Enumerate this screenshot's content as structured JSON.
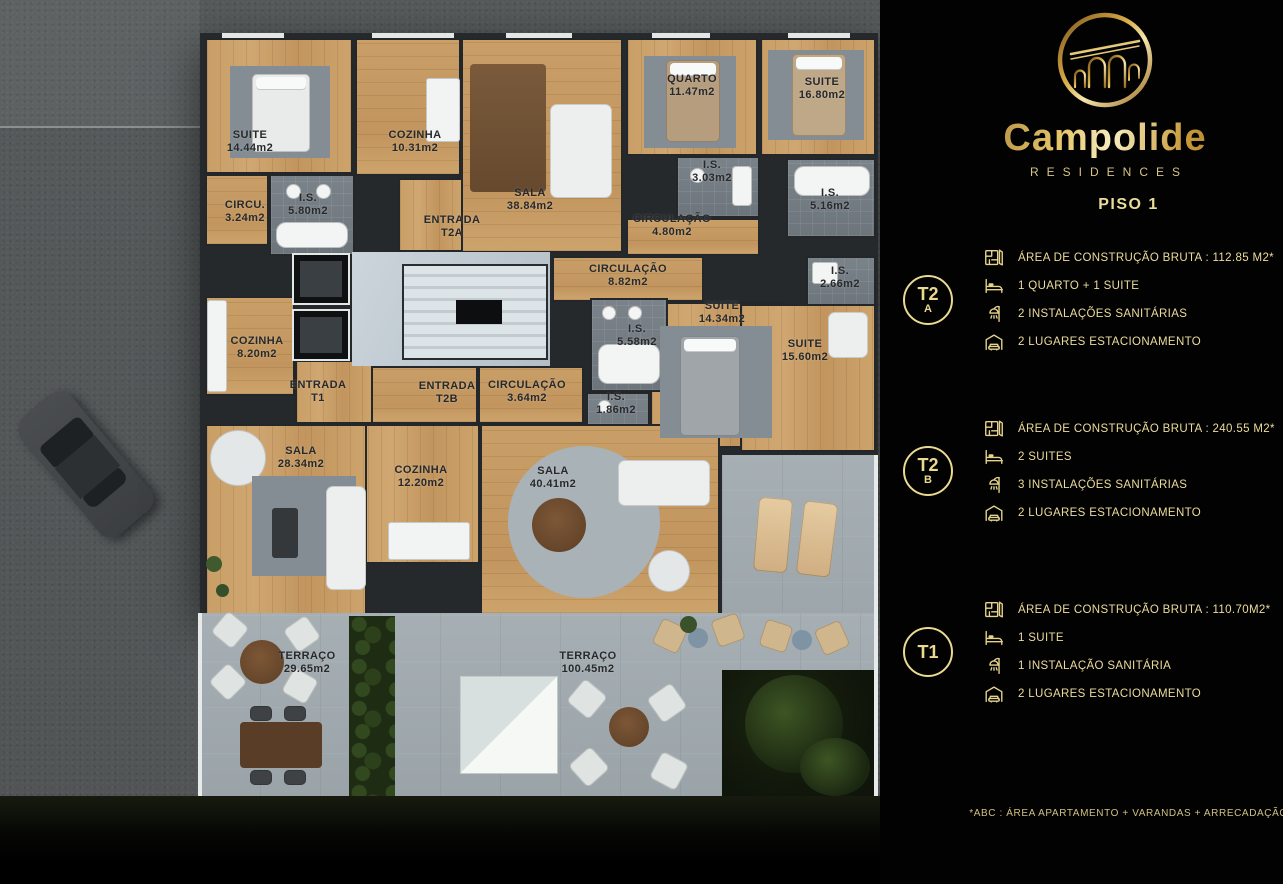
{
  "brand": {
    "name": "Campolide",
    "subtitle": "RESIDENCES"
  },
  "floor": {
    "title": "PISO 1"
  },
  "footnote": "*ABC :  ÁREA APARTAMENTO + VARANDAS + ARRECADAÇÃO",
  "accent_gold": "#ead98f",
  "units": [
    {
      "id": "T2A",
      "badge_top": "T2",
      "badge_bottom": "A",
      "specs": [
        {
          "icon": "floorplan-icon",
          "text": "ÁREA DE CONSTRUÇÃO BRUTA :  112.85 M2*"
        },
        {
          "icon": "bed-icon",
          "text": "1 QUARTO + 1 SUITE"
        },
        {
          "icon": "shower-icon",
          "text": "2 INSTALAÇÕES SANITÁRIAS"
        },
        {
          "icon": "garage-icon",
          "text": "2 LUGARES ESTACIONAMENTO"
        }
      ]
    },
    {
      "id": "T2B",
      "badge_top": "T2",
      "badge_bottom": "B",
      "specs": [
        {
          "icon": "floorplan-icon",
          "text": "ÁREA DE CONSTRUÇÃO BRUTA :  240.55 M2*"
        },
        {
          "icon": "bed-icon",
          "text": "2 SUITES"
        },
        {
          "icon": "shower-icon",
          "text": "3 INSTALAÇÕES SANITÁRIAS"
        },
        {
          "icon": "garage-icon",
          "text": "2 LUGARES ESTACIONAMENTO"
        }
      ]
    },
    {
      "id": "T1",
      "badge_top": "T1",
      "badge_bottom": "",
      "specs": [
        {
          "icon": "floorplan-icon",
          "text": "ÁREA DE CONSTRUÇÃO BRUTA :  110.70M2*"
        },
        {
          "icon": "bed-icon",
          "text": "1 SUITE"
        },
        {
          "icon": "shower-icon",
          "text": "1 INSTALAÇÃO SANITÁRIA"
        },
        {
          "icon": "garage-icon",
          "text": "2 LUGARES ESTACIONAMENTO"
        }
      ]
    }
  ],
  "floorplan": {
    "labels": [
      {
        "line1": "SUITE",
        "line2": "14.44m2"
      },
      {
        "line1": "COZINHA",
        "line2": "10.31m2"
      },
      {
        "line1": "CIRCU.",
        "line2": "3.24m2"
      },
      {
        "line1": "I.S.",
        "line2": "5.80m2"
      },
      {
        "line1": "ENTRADA",
        "line2": "T2A"
      },
      {
        "line1": "SALA",
        "line2": "38.84m2"
      },
      {
        "line1": "QUARTO",
        "line2": "11.47m2"
      },
      {
        "line1": "I.S.",
        "line2": "3.03m2"
      },
      {
        "line1": "SUITE",
        "line2": "16.80m2"
      },
      {
        "line1": "CIRCULAÇÃO",
        "line2": "4.80m2"
      },
      {
        "line1": "I.S.",
        "line2": "5.16m2"
      },
      {
        "line1": "CIRCULAÇÃO",
        "line2": "8.82m2"
      },
      {
        "line1": "I.S.",
        "line2": "2.66m2"
      },
      {
        "line1": "SUITE",
        "line2": "14.34m2"
      },
      {
        "line1": "I.S.",
        "line2": "5.58m2"
      },
      {
        "line1": "SUITE",
        "line2": "15.60m2"
      },
      {
        "line1": "COZINHA",
        "line2": "8.20m2"
      },
      {
        "line1": "ENTRADA",
        "line2": "T1"
      },
      {
        "line1": "ENTRADA",
        "line2": "T2B"
      },
      {
        "line1": "CIRCULAÇÃO",
        "line2": "3.64m2"
      },
      {
        "line1": "I.S.",
        "line2": "1.86m2"
      },
      {
        "line1": "SALA",
        "line2": "28.34m2"
      },
      {
        "line1": "COZINHA",
        "line2": "12.20m2"
      },
      {
        "line1": "SALA",
        "line2": "40.41m2"
      },
      {
        "line1": "TERRAÇO",
        "line2": "29.65m2"
      },
      {
        "line1": "TERRAÇO",
        "line2": "100.45m2"
      }
    ]
  }
}
